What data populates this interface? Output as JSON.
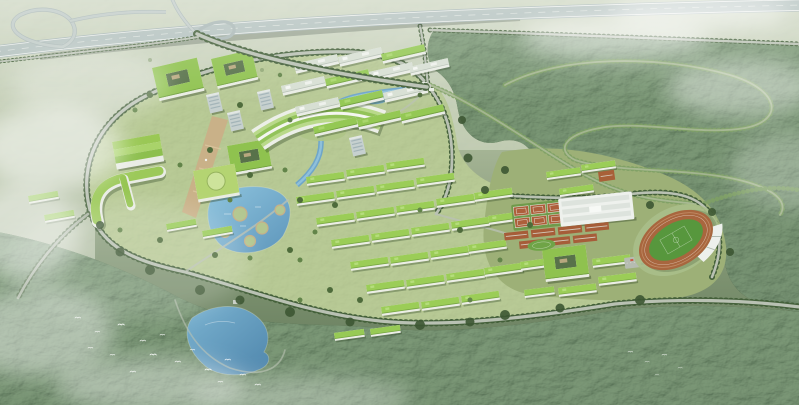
{
  "scene": {
    "type": "aerial-architectural-rendering",
    "subject": "bird's-eye masterplan rendering of a green campus: highway interchange, tree-lined entrance avenue, white academic slabs, arc-shaped terraced building, central plaza, twin lakes, green-roofed dormitory rows, gymnasium, running-track stadium with grandstand, tennis courts, parking, surrounding forest with winding tree-lined roads, low mist and bird flocks"
  },
  "features": {
    "highway_interchange": "elevated expressway with loop ramp",
    "entrance_avenue": "tree-lined approach road from interchange",
    "academic_cluster": "white slab teaching buildings",
    "courtyard_blocks": "green-roof courtyard buildings",
    "library_arc": "white arc building with terraced green roof",
    "central_plaza": "tan paved axis plaza",
    "upper_lake": "campus lake with circular gardens",
    "canal": "water channel through campus",
    "lower_lake": "forest lake",
    "dormitory_rows": "bright green-roofed dormitory slabs",
    "gymnasium": "large white flat-roof sports hall",
    "stadium": "oval running track, green pitch, white grandstand canopy",
    "tennis_courts": "red courts on green apron",
    "parking": "striped parking strip with cars",
    "forest": "dense woodland with winding tree-lined loop roads",
    "mist": "low white clouds drifting over fields",
    "birds": "flocks of small white birds"
  },
  "colors": {
    "field_top": "#c9d2c0",
    "field_mid": "#a7b697",
    "field_low": "#7d9270",
    "horizon_deep": "#5c7354",
    "forest_top": "#3f5a36",
    "forest_bottom": "#243621",
    "campus_lawn": "#9fb478",
    "green_roof": "#94c854",
    "green_roof_bright": "#9bcd57",
    "facade_white": "#e9ece5",
    "roof_grey": "#d7dfd3",
    "tower_grey": "#c6d0cf",
    "water_light": "#8ec4de",
    "water_deep": "#5e96bb",
    "lake_light": "#7ab2d0",
    "lake_deep": "#4f86ac",
    "canal": "#6fa6c9",
    "plaza_tan": "#c9b188",
    "running_track": "#a8663e",
    "pitch_green": "#57973d",
    "court_red": "#ad5f3b",
    "road_grey": "#b9c1b3",
    "highway_deck": "#a9b8b6",
    "highway_inner": "#b4c2bf",
    "tree_dark": "#44603a",
    "tree_light": "#7fa065",
    "bird_white": "#ffffff",
    "mist_white": "#ffffff",
    "shadow_green": "#2f4426"
  }
}
